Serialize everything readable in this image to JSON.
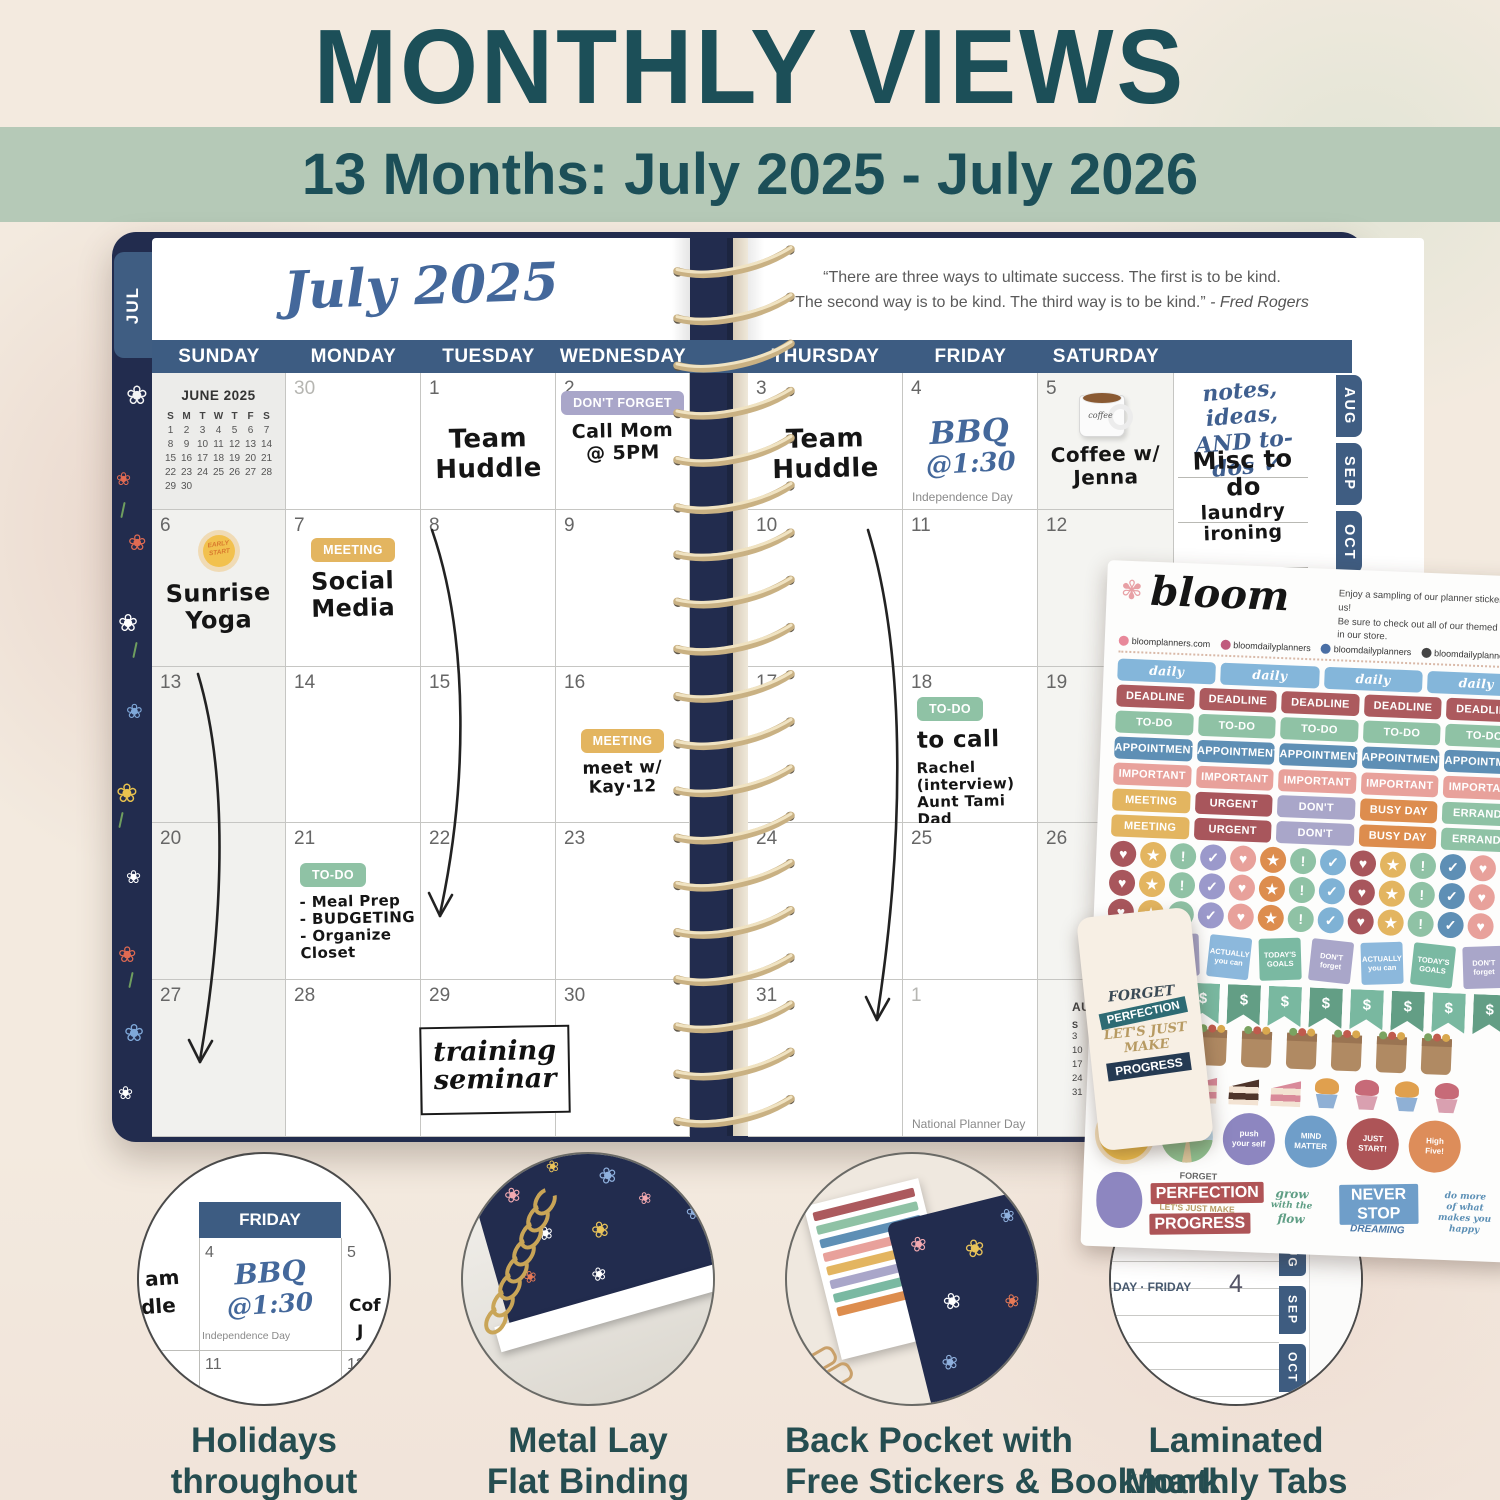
{
  "header": {
    "title": "MONTHLY VIEWS",
    "banner": "13 Months: July 2025 - July 2026"
  },
  "colors": {
    "title_teal": "#1c4f58",
    "banner_green": "#b5c9b7",
    "header_navy": "#3d5c82",
    "cover_navy": "#222c4e",
    "script_blue": "#44689b",
    "caption_teal": "#254d50",
    "coil_gold": "#d3ba88"
  },
  "planner": {
    "left_tab": "JUL",
    "right_tabs": [
      "AUG",
      "SEP",
      "OCT",
      "N"
    ],
    "month_title": "July 2025",
    "quote": {
      "line1": "“There are three ways to ultimate success. The first is to be kind.",
      "line2": "The second way is to be kind. The third way is to be kind.”",
      "attribution": "- Fred Rogers"
    },
    "day_headers_left": [
      "SUNDAY",
      "MONDAY",
      "TUESDAY",
      "WEDNESDAY"
    ],
    "day_headers_right": [
      "THURSDAY",
      "FRIDAY",
      "SATURDAY"
    ],
    "mini_june": {
      "title": "JUNE 2025",
      "dow": [
        "S",
        "M",
        "T",
        "W",
        "T",
        "F",
        "S"
      ],
      "weeks": [
        [
          "1",
          "2",
          "3",
          "4",
          "5",
          "6",
          "7"
        ],
        [
          "8",
          "9",
          "10",
          "11",
          "12",
          "13",
          "14"
        ],
        [
          "15",
          "16",
          "17",
          "18",
          "19",
          "20",
          "21"
        ],
        [
          "22",
          "23",
          "24",
          "25",
          "26",
          "27",
          "28"
        ],
        [
          "29",
          "30",
          "",
          "",
          "",
          "",
          ""
        ]
      ]
    },
    "mini_august": {
      "title": "AUGUST 2025",
      "dow": "S M",
      "sundays": [
        "3",
        "10",
        "17",
        "24",
        "31"
      ]
    },
    "notes": {
      "header1": "notes, ideas,",
      "header2": "AND to-dos ✓",
      "lines": [
        "Misc to do",
        "laundry",
        "ironing"
      ]
    },
    "training_box": [
      "training",
      "seminar"
    ],
    "cells_left": [
      {
        "row": 1,
        "col": 1,
        "mini": "june"
      },
      {
        "row": 1,
        "col": 2,
        "date": "30",
        "muted": true
      },
      {
        "row": 1,
        "col": 3,
        "date": "1",
        "hand": [
          "Team",
          "Huddle"
        ],
        "hsize": 26,
        "htop": 52
      },
      {
        "row": 1,
        "col": 4,
        "date": "2",
        "sticker": {
          "text": "DON'T FORGET",
          "color": "#a9a6c9"
        },
        "hand": [
          "Call Mom",
          "@ 5PM"
        ],
        "hsize": 19,
        "htop": 18
      },
      {
        "row": 2,
        "col": 1,
        "date": "6",
        "icon": "sun",
        "hand": [
          "Sunrise",
          "Yoga"
        ],
        "hsize": 24,
        "htop": 16
      },
      {
        "row": 2,
        "col": 2,
        "date": "7",
        "sticker": {
          "text": "MEETING",
          "color": "#e3b560"
        },
        "hand": [
          "Social",
          "Media"
        ],
        "hsize": 24,
        "htop": 28
      },
      {
        "row": 2,
        "col": 3,
        "date": "8"
      },
      {
        "row": 2,
        "col": 4,
        "date": "9"
      },
      {
        "row": 3,
        "col": 1,
        "date": "13"
      },
      {
        "row": 3,
        "col": 2,
        "date": "14"
      },
      {
        "row": 3,
        "col": 3,
        "date": "15"
      },
      {
        "row": 3,
        "col": 4,
        "date": "16",
        "sticker": {
          "text": "MEETING",
          "color": "#e3b560"
        },
        "hand": [
          "meet w/ Kay·12"
        ],
        "hsize": 17,
        "htop": 62
      },
      {
        "row": 4,
        "col": 1,
        "date": "20"
      },
      {
        "row": 4,
        "col": 2,
        "date": "21",
        "sticker": {
          "text": "TO-DO",
          "color": "#8fc2a5"
        },
        "hand": [
          "- Meal Prep",
          "- BUDGETING",
          "- Organize Closet"
        ],
        "hsize": 15,
        "htop": 40,
        "halign": "left"
      },
      {
        "row": 4,
        "col": 3,
        "date": "22"
      },
      {
        "row": 4,
        "col": 4,
        "date": "23"
      },
      {
        "row": 5,
        "col": 1,
        "date": "27"
      },
      {
        "row": 5,
        "col": 2,
        "date": "28"
      },
      {
        "row": 5,
        "col": 3,
        "date": "29"
      },
      {
        "row": 5,
        "col": 4,
        "date": "30"
      }
    ],
    "cells_right": [
      {
        "row": 1,
        "col": 1,
        "date": "3",
        "hand": [
          "Team",
          "Huddle"
        ],
        "hsize": 26,
        "htop": 52
      },
      {
        "row": 1,
        "col": 2,
        "date": "4",
        "script": [
          "BBQ",
          "@1:30"
        ],
        "holiday": "Independence Day"
      },
      {
        "row": 1,
        "col": 3,
        "date": "5",
        "icon": "mug",
        "hand": [
          "Coffee w/",
          "Jenna"
        ],
        "hsize": 20,
        "htop": 14
      },
      {
        "row": 2,
        "col": 1,
        "date": "10"
      },
      {
        "row": 2,
        "col": 2,
        "date": "11"
      },
      {
        "row": 2,
        "col": 3,
        "date": "12"
      },
      {
        "row": 3,
        "col": 1,
        "date": "17"
      },
      {
        "row": 3,
        "col": 2,
        "date": "18",
        "sticker": {
          "text": "TO-DO",
          "color": "#8fc2a5"
        },
        "lead": "to call",
        "hand": [
          "Rachel (interview)",
          "Aunt Tami",
          "Dad"
        ],
        "hsize": 15,
        "htop": 30,
        "halign": "left"
      },
      {
        "row": 3,
        "col": 3,
        "date": "19"
      },
      {
        "row": 4,
        "col": 1,
        "date": "24"
      },
      {
        "row": 4,
        "col": 2,
        "date": "25"
      },
      {
        "row": 4,
        "col": 3,
        "date": "26"
      },
      {
        "row": 5,
        "col": 1,
        "date": "31"
      },
      {
        "row": 5,
        "col": 2,
        "date": "1",
        "muted": true,
        "holiday": "National Planner Day"
      },
      {
        "row": 5,
        "col": 3,
        "mini": "august"
      }
    ]
  },
  "sheet": {
    "brand": "bloom",
    "blurb1": "Enjoy a sampling of our planner stickers, on us!",
    "blurb2": "Be sure to check out all of our themed packs in our store.",
    "socials": [
      {
        "icon": "flower-icon",
        "color": "#e8889a",
        "text": "bloomplanners.com"
      },
      {
        "icon": "instagram-icon",
        "color": "#c05b7d",
        "text": "bloomdailyplanners"
      },
      {
        "icon": "facebook-icon",
        "color": "#4a6fa5",
        "text": "bloomdailyplanners"
      },
      {
        "icon": "tiktok-icon",
        "color": "#444444",
        "text": "bloomdailyplanners"
      }
    ],
    "label_rows": [
      {
        "script": true,
        "items": [
          {
            "t": "daily gratitude",
            "c": "#84b6da"
          },
          {
            "t": "daily gratitude",
            "c": "#84b6da"
          },
          {
            "t": "daily gratitude",
            "c": "#84b6da"
          },
          {
            "t": "daily gratitude",
            "c": "#84b6da"
          }
        ]
      },
      {
        "items": [
          {
            "t": "DEADLINE",
            "c": "#ac5a5e"
          },
          {
            "t": "DEADLINE",
            "c": "#ac5a5e"
          },
          {
            "t": "DEADLINE",
            "c": "#ac5a5e"
          },
          {
            "t": "DEADLINE",
            "c": "#ac5a5e"
          },
          {
            "t": "DEADLINE",
            "c": "#ac5a5e"
          }
        ]
      },
      {
        "items": [
          {
            "t": "TO-DO",
            "c": "#8fc2a5"
          },
          {
            "t": "TO-DO",
            "c": "#8fc2a5"
          },
          {
            "t": "TO-DO",
            "c": "#8fc2a5"
          },
          {
            "t": "TO-DO",
            "c": "#8fc2a5"
          },
          {
            "t": "TO-DO",
            "c": "#8fc2a5"
          }
        ]
      },
      {
        "items": [
          {
            "t": "APPOINTMENT",
            "c": "#5e8fb5"
          },
          {
            "t": "APPOINTMENT",
            "c": "#5e8fb5"
          },
          {
            "t": "APPOINTMENT",
            "c": "#5e8fb5"
          },
          {
            "t": "APPOINTMENT",
            "c": "#5e8fb5"
          },
          {
            "t": "APPOINTMENT",
            "c": "#5e8fb5"
          }
        ]
      },
      {
        "items": [
          {
            "t": "IMPORTANT",
            "c": "#e8a19b"
          },
          {
            "t": "IMPORTANT",
            "c": "#e8a19b"
          },
          {
            "t": "IMPORTANT",
            "c": "#e8a19b"
          },
          {
            "t": "IMPORTANT",
            "c": "#e8a19b"
          },
          {
            "t": "IMPORTANT",
            "c": "#e8a19b"
          }
        ]
      },
      {
        "items": [
          {
            "t": "MEETING",
            "c": "#e3b560"
          },
          {
            "t": "URGENT",
            "c": "#a8565c"
          },
          {
            "t": "DON'T FORGET",
            "c": "#a9a6c9"
          },
          {
            "t": "BUSY DAY",
            "c": "#dd8d4e"
          },
          {
            "t": "ERRANDS",
            "c": "#8fc2a5"
          }
        ]
      },
      {
        "items": [
          {
            "t": "MEETING",
            "c": "#e3b560"
          },
          {
            "t": "URGENT",
            "c": "#a8565c"
          },
          {
            "t": "DON'T FORGET",
            "c": "#a9a6c9"
          },
          {
            "t": "BUSY DAY",
            "c": "#dd8d4e"
          },
          {
            "t": "ERRANDS",
            "c": "#8fc2a5"
          }
        ]
      }
    ],
    "dot_rows": 3,
    "dot_pattern": [
      {
        "g": "♥",
        "c": "#a8565c"
      },
      {
        "g": "★",
        "c": "#e3b560"
      },
      {
        "g": "!",
        "c": "#8fc2a5"
      },
      {
        "g": "✓",
        "c": "#9b99cb"
      },
      {
        "g": "♥",
        "c": "#e8a19b"
      },
      {
        "g": "★",
        "c": "#dd8d4e"
      },
      {
        "g": "!",
        "c": "#8fc2a5"
      },
      {
        "g": "✓",
        "c": "#7fb2d5"
      },
      {
        "g": "♥",
        "c": "#a8565c"
      },
      {
        "g": "★",
        "c": "#e3b560"
      },
      {
        "g": "!",
        "c": "#8fc2a5"
      },
      {
        "g": "✓",
        "c": "#5e8fb5"
      },
      {
        "g": "♥",
        "c": "#e8a19b"
      }
    ],
    "note_squares": [
      {
        "t": "TODAY'S GOALS",
        "c": "#7ab9a2"
      },
      {
        "t": "DON'T forget",
        "c": "#a9a6c9"
      },
      {
        "t": "ACTUALLY you can",
        "c": "#8cb8dc"
      },
      {
        "t": "TODAY'S GOALS",
        "c": "#7ab9a2"
      },
      {
        "t": "DON'T forget",
        "c": "#a9a6c9"
      },
      {
        "t": "ACTUALLY you can",
        "c": "#8cb8dc"
      },
      {
        "t": "TODAY'S GOALS",
        "c": "#7ab9a2"
      },
      {
        "t": "DON'T forget",
        "c": "#a9a6c9"
      }
    ],
    "flags": {
      "glyph": "$",
      "count": 10,
      "colors": [
        "#79b8a0",
        "#639e85"
      ]
    },
    "bags_count": 8,
    "cakes": [
      "slice-pink",
      "slice-choc",
      "slice-pink",
      "slice-choc",
      "slice-pink",
      "cup-orange",
      "cup-pink",
      "cup-orange",
      "cup-pink"
    ],
    "big_circles": [
      {
        "type": "sun",
        "t1": "EARLY",
        "t2": "START",
        "c": "#f2c14e"
      },
      {
        "type": "landscape",
        "t1": "",
        "t2": "",
        "c": "#bcd9ea"
      },
      {
        "type": "text",
        "t1": "push",
        "t2": "your self",
        "c": "#8d86c0"
      },
      {
        "type": "text",
        "t1": "MIND",
        "t2": "MATTER",
        "c": "#6f9ec9"
      },
      {
        "type": "text",
        "t1": "JUST",
        "t2": "START!",
        "c": "#ad5457"
      },
      {
        "type": "text",
        "t1": "High",
        "t2": "Five!",
        "c": "#dd8d5a"
      }
    ],
    "quotes": {
      "q1": [
        "FORGET",
        "PERFECTION",
        "LET'S JUST MAKE",
        "PROGRESS"
      ],
      "q2": [
        "grow",
        "with the",
        "flow"
      ],
      "q3": [
        "NEVER STOP",
        "DREAMING"
      ],
      "q4": [
        "do more",
        "of what",
        "makes you",
        "happy"
      ]
    }
  },
  "bookmark": {
    "lines": [
      "FORGET",
      "PERFECTION",
      "LET'S JUST",
      "MAKE",
      "PROGRESS"
    ]
  },
  "features": [
    {
      "caption1": "Holidays",
      "caption2": "throughout"
    },
    {
      "caption1": "Metal Lay",
      "caption2": "Flat Binding"
    },
    {
      "caption1": "Back Pocket with",
      "caption2": "Free Stickers & Bookmark"
    },
    {
      "caption1": "Laminated",
      "caption2": "Monthly Tabs"
    }
  ],
  "feature1": {
    "day": "FRIDAY",
    "d4": "4",
    "d5": "5",
    "d11": "11",
    "d12": "12",
    "script1": "BBQ",
    "script2": "@1:30",
    "holiday": "Independence Day",
    "p1": "am",
    "p2": "dle",
    "p3": "Cof",
    "p4": "J"
  },
  "feature4": {
    "top": "3",
    "label": "DAY · FRIDAY",
    "num": "4",
    "tabs": [
      "JUL",
      "AUG",
      "SEP",
      "OCT"
    ]
  }
}
